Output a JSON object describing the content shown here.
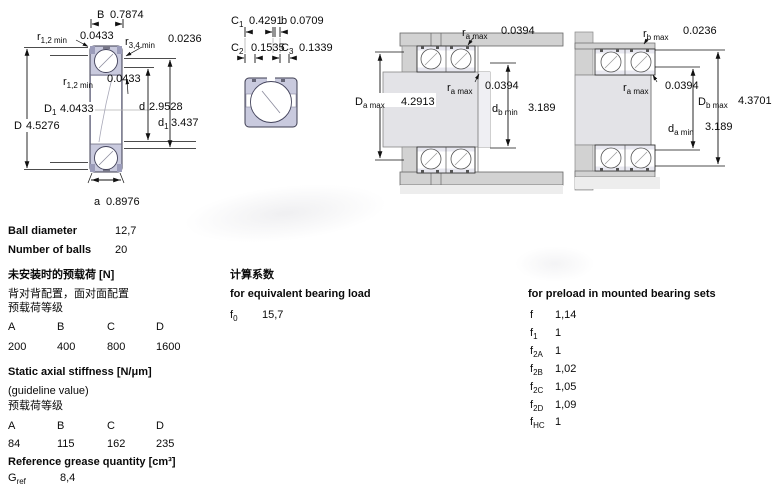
{
  "page": {
    "background": "#ffffff"
  },
  "colors": {
    "bearing_ring_fill": "#c9cade",
    "steel_gray": "#d2d2d2",
    "line": "#1a1a1a"
  },
  "specs": {
    "ball_diameter_label": "Ball diameter",
    "ball_diameter": "12,7",
    "number_of_balls_label": "Number of balls",
    "number_of_balls": "20"
  },
  "preload_unmounted": {
    "title_zh": "未安装时的预载荷 [N]",
    "subtitle_zh": "背对背配置，面对面配置",
    "class_label_zh": "预载荷等级",
    "headers": [
      "A",
      "B",
      "C",
      "D"
    ],
    "values": [
      "200",
      "400",
      "800",
      "1600"
    ]
  },
  "stiffness": {
    "title": "Static axial stiffness [N/μm]",
    "subtitle": "(guideline value)",
    "class_label_zh": "预载荷等级",
    "headers": [
      "A",
      "B",
      "C",
      "D"
    ],
    "values": [
      "84",
      "115",
      "162",
      "235"
    ]
  },
  "grease": {
    "title": "Reference grease quantity [cm³]",
    "sym": "G",
    "sub": "ref",
    "value": "8,4"
  },
  "calc_factors": {
    "title_zh": "计算系数",
    "subtitle": "for equivalent bearing load",
    "f0": {
      "sym": "f",
      "sub": "0",
      "value": "15,7"
    }
  },
  "preload_factors": {
    "title": "for preload in mounted bearing sets",
    "rows": [
      {
        "sym": "f",
        "sub": "",
        "value": "1,14"
      },
      {
        "sym": "f",
        "sub": "1",
        "value": "1"
      },
      {
        "sym": "f",
        "sub": "2A",
        "value": "1"
      },
      {
        "sym": "f",
        "sub": "2B",
        "value": "1,02"
      },
      {
        "sym": "f",
        "sub": "2C",
        "value": "1,05"
      },
      {
        "sym": "f",
        "sub": "2D",
        "value": "1,09"
      },
      {
        "sym": "f",
        "sub": "HC",
        "value": "1"
      }
    ]
  },
  "figures": {
    "fig1": {
      "B": {
        "pre": "B",
        "sub": "",
        "val": "0.7874"
      },
      "r12_top": {
        "pre": "r",
        "sub": "1,2 min",
        "val": "0.0433"
      },
      "r34": {
        "pre": "r",
        "sub": "3,4 min",
        "val": "0.0236"
      },
      "r12_mid": {
        "pre": "r",
        "sub": "1,2 min",
        "val": "0.0433"
      },
      "D1": {
        "pre": "D",
        "sub": "1",
        "val": "4.0433"
      },
      "D": {
        "pre": "D",
        "sub": "",
        "val": "4.5276"
      },
      "d": {
        "pre": "d",
        "sub": "",
        "val": "2.9528"
      },
      "d1": {
        "pre": "d",
        "sub": "1",
        "val": "3.437"
      },
      "a": {
        "pre": "a",
        "sub": "",
        "val": "0.8976"
      }
    },
    "fig2": {
      "C1": {
        "pre": "C",
        "sub": "1",
        "val": "0.4291"
      },
      "b": {
        "pre": "b",
        "sub": "",
        "val": "0.0709"
      },
      "C2": {
        "pre": "C",
        "sub": "2",
        "val": "0.1535"
      },
      "C3": {
        "pre": "C",
        "sub": "3",
        "val": "0.1339"
      }
    },
    "fig3": {
      "ra_top": {
        "pre": "r",
        "sub": "a max",
        "val": "0.0394"
      },
      "ra_mid": {
        "pre": "r",
        "sub": "a max",
        "val": "0.0394"
      },
      "Da": {
        "pre": "D",
        "sub": "a max",
        "val": "4.2913"
      },
      "db": {
        "pre": "d",
        "sub": "b min",
        "val": "3.189"
      }
    },
    "fig4": {
      "rb": {
        "pre": "r",
        "sub": "b max",
        "val": "0.0236"
      },
      "ra": {
        "pre": "r",
        "sub": "a max",
        "val": "0.0394"
      },
      "Db": {
        "pre": "D",
        "sub": "b max",
        "val": "4.3701"
      },
      "da": {
        "pre": "d",
        "sub": "a min",
        "val": "3.189"
      }
    }
  }
}
